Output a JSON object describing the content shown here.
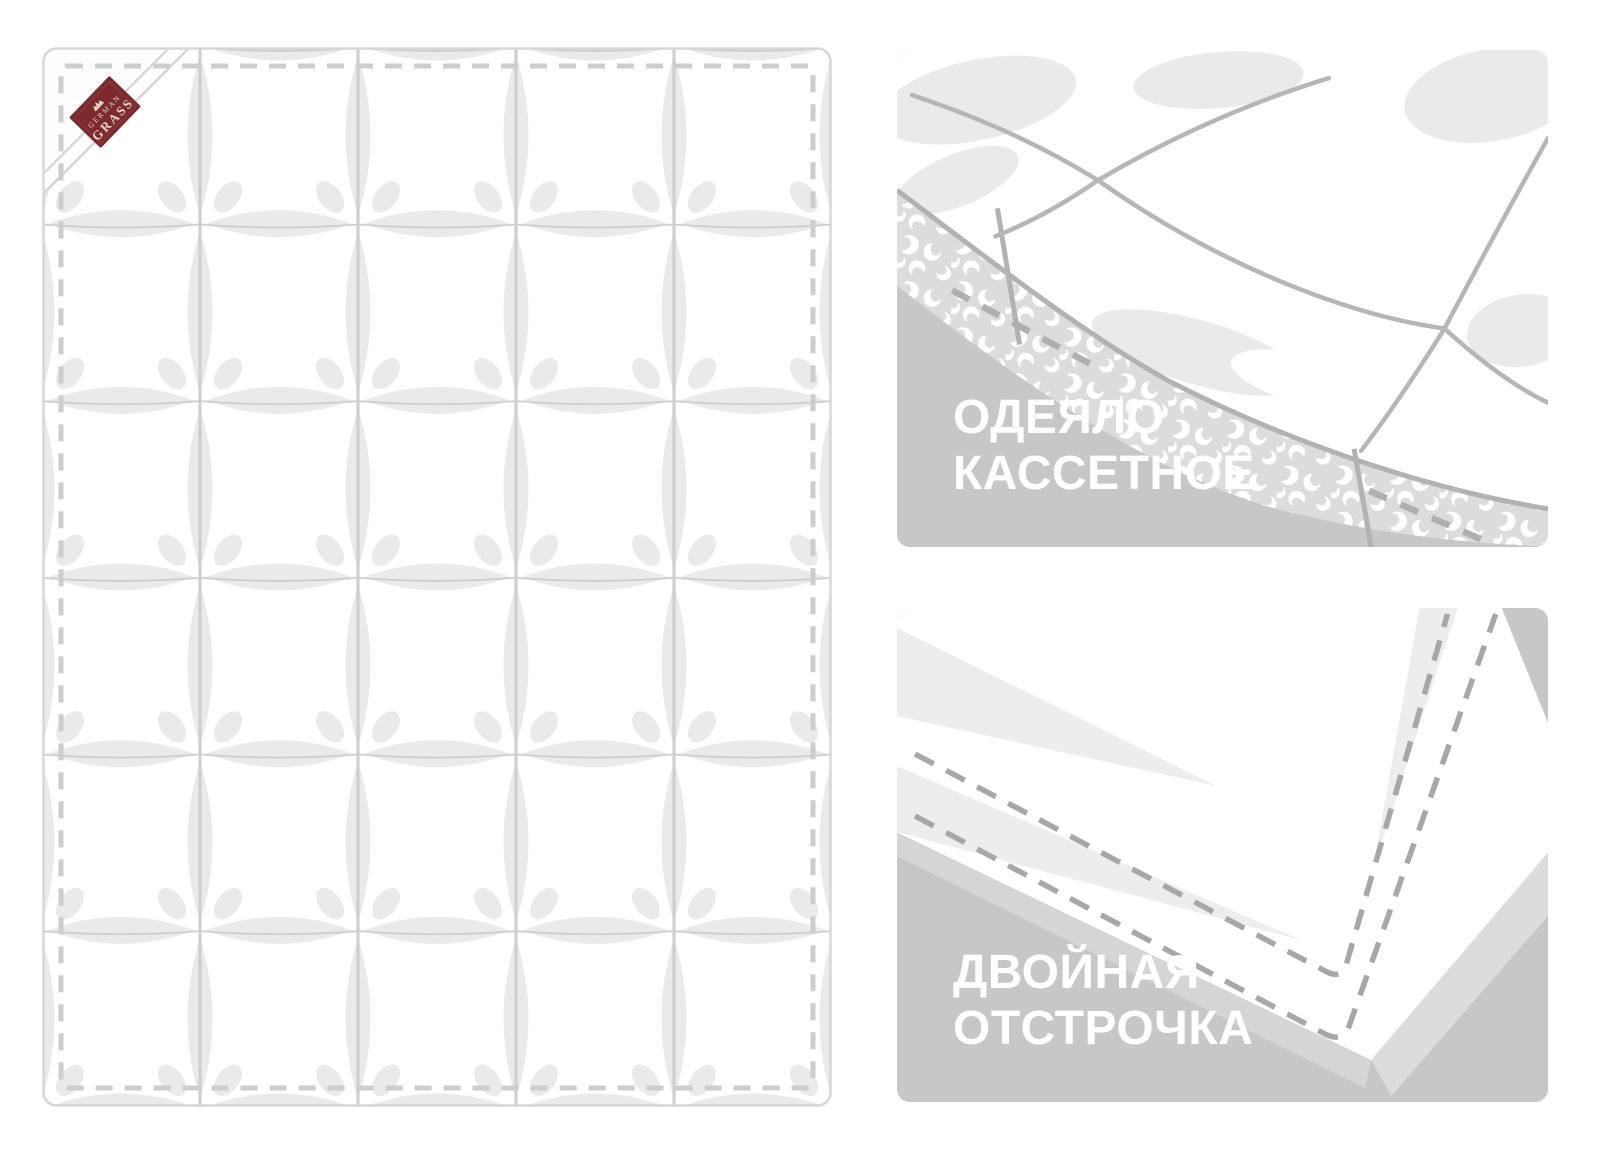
{
  "stage": {
    "description": "Product feature illustration of a cassette down duvet",
    "width": 1600,
    "height": 1154,
    "background": "#ffffff"
  },
  "quilt": {
    "grid_columns": 5,
    "grid_rows": 6,
    "brand_label": {
      "line1": "GERMAN",
      "line2": "GRASS"
    }
  },
  "panels": {
    "cassette": {
      "line1": "ОДЕЯЛО",
      "line2": "КАССЕТНОЕ"
    },
    "stitching": {
      "line1": "ДВОЙНАЯ",
      "line2": "ОТСТРОЧКА"
    }
  },
  "colors": {
    "panel_background": "#c6c8c7",
    "panel_title_text": "#ffffff",
    "brand_label_background": "#7b2a2d",
    "brand_label_text": "#e8d6c2",
    "quilt_outline": "#d6d8d8",
    "quilt_stitch_dash": "#cbcecd",
    "quilt_lens": "#e9ebea",
    "illustration_line": "#b1b3b2",
    "feather_wall_background": "#dbdddc",
    "panel_stitch_dash": "#a6a8a7"
  }
}
